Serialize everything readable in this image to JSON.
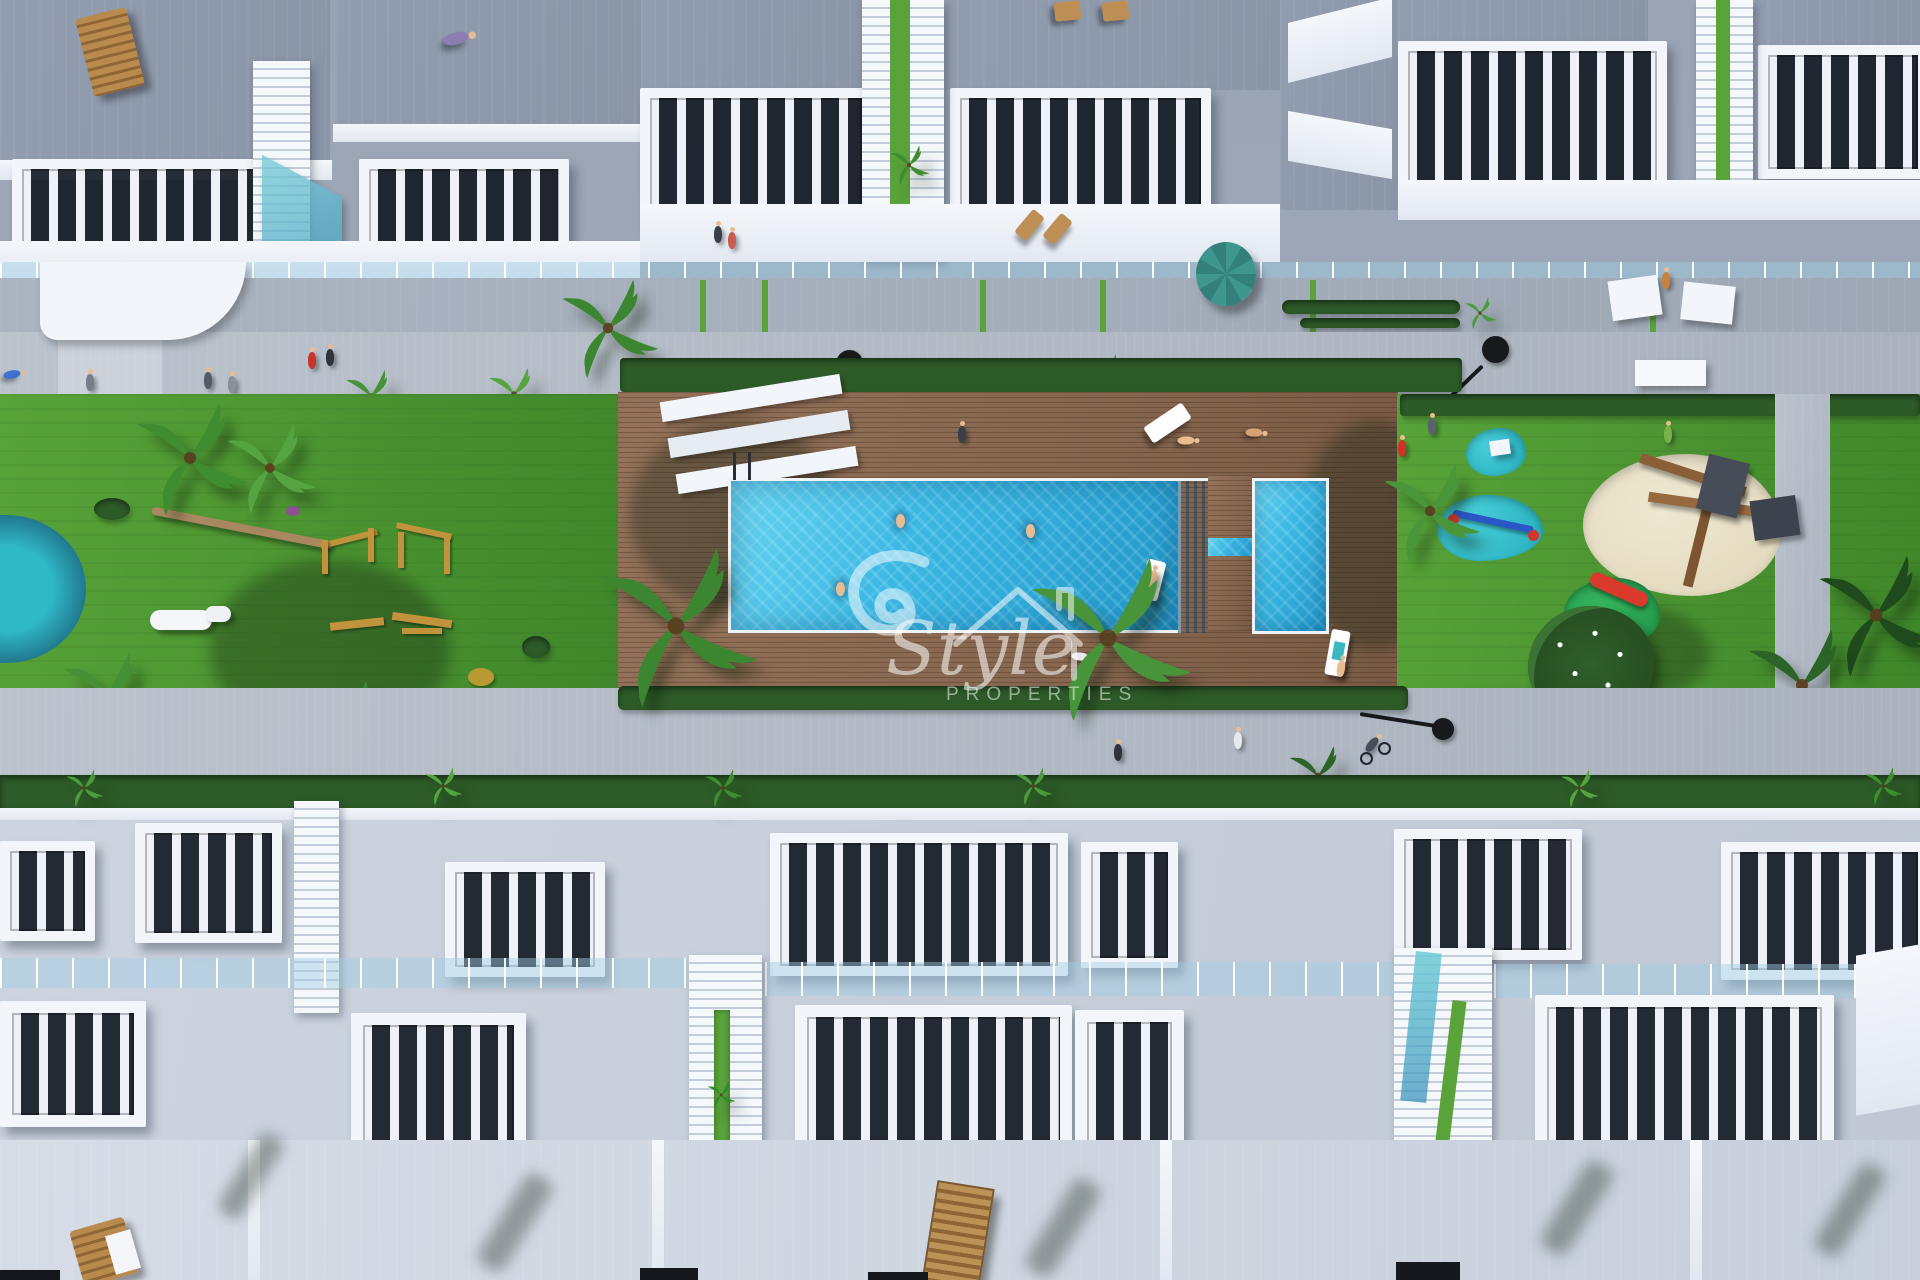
{
  "image_type": "3d-aerial-architectural-render",
  "watermark": {
    "script_word": "Style",
    "caption_word": "PROPERTIES"
  },
  "palette": {
    "pavement": "#b4bcc6",
    "deck_wood": "#8b6a51",
    "pool_water": "#38bce6",
    "lawn_green": "#4f9a33",
    "hedge_green": "#2d5b28",
    "building_white": "#eef2f8",
    "roof_terrace_gray": "#96a0b0",
    "pergola_gap_dark": "#272d37",
    "glass_blue": "#aad2e4",
    "playground_pad_teal": "#2db9c7",
    "sand_beige": "#e7dfc8",
    "play_wood_yellow": "#c1933d",
    "lamp_black": "#17191c",
    "umbrella_teal": "#3d8f86",
    "slide_red": "#d93a2b",
    "watermark_white": "rgba(255,255,255,0.55)"
  },
  "scene": {
    "description": "Top-down aerial render of a white townhouse residential complex with a communal amenity strip",
    "features": [
      "rows of white townhouses with slatted pergola roof terraces",
      "communal swimming pool with wide entry steps on a wooden deck",
      "separate kids pool",
      "sun loungers and swimmers",
      "lawn with outdoor gym equipment and pond",
      "children playground with teal safety pads, seesaw and red slide",
      "sand pit with wooden climbing frame",
      "palm trees and hedges",
      "pedestrian walkways with street lamps"
    ]
  }
}
